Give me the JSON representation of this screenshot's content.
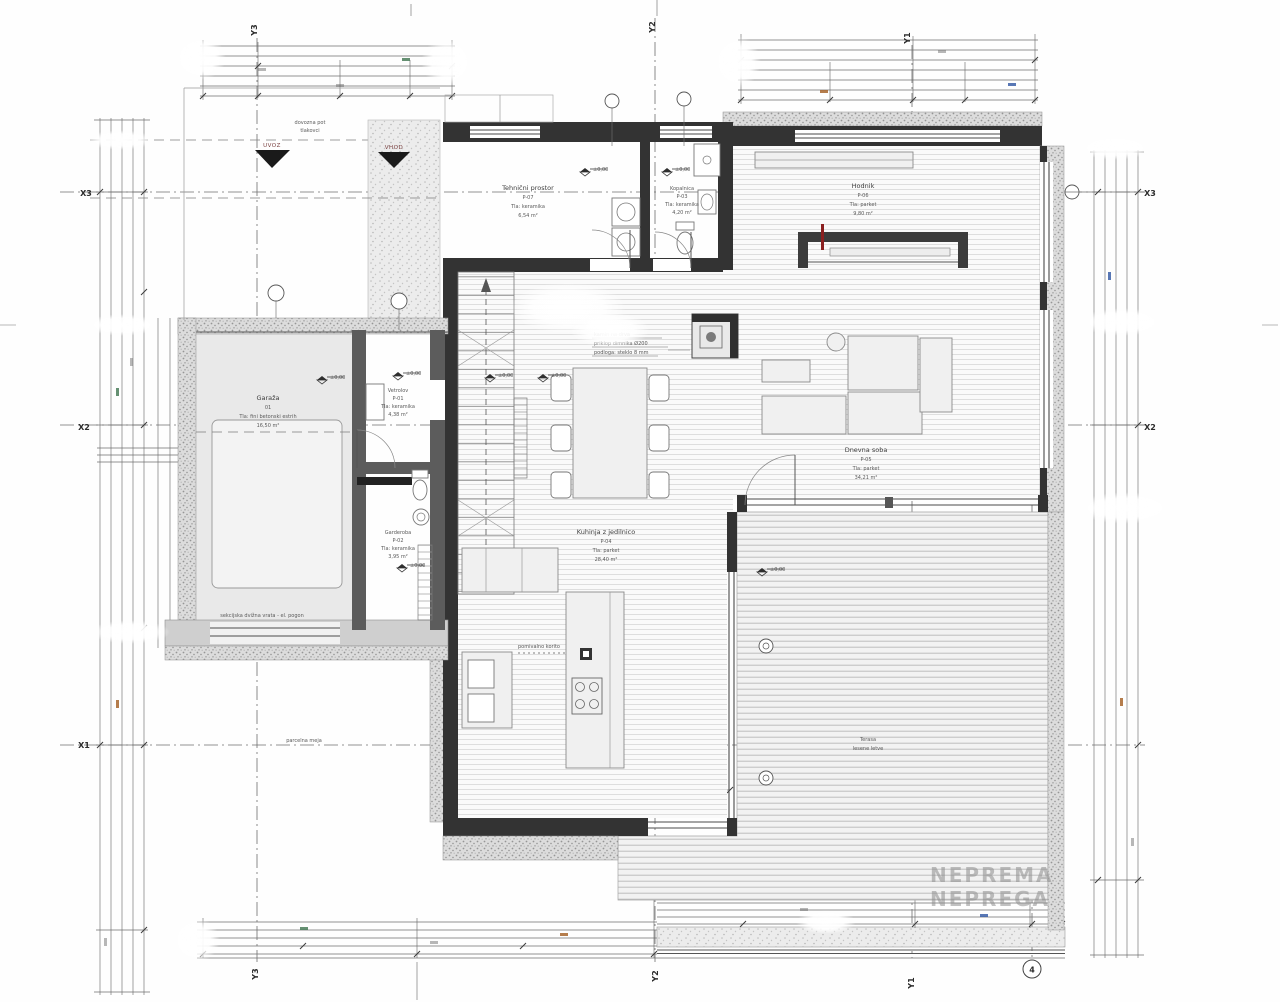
{
  "drawing": {
    "type": "architectural floor plan, ground floor",
    "accent_wall_color": "#333333",
    "stipple_wall_color": "#dcdcdc",
    "paper_color": "#fefefe"
  },
  "grid": {
    "top": [
      "Y3",
      "Y2",
      "Y1"
    ],
    "bottom": [
      "Y3",
      "Y2",
      "Y1"
    ],
    "left": [
      "X3",
      "X2",
      "X1"
    ],
    "right": [
      "X3",
      "X2"
    ],
    "axis_bubble": "4"
  },
  "rooms": {
    "garage": {
      "lines": [
        "Garaža",
        "01",
        "Tla: fini betonski estrih",
        "16,50 m²"
      ]
    },
    "vetrolov": {
      "lines": [
        "Vetrolov",
        "P-01",
        "Tla: keramika",
        "4,38 m²"
      ]
    },
    "garderoba": {
      "lines": [
        "Garderoba",
        "P-02",
        "Tla: keramika",
        "3,95 m²"
      ]
    },
    "utility": {
      "lines": [
        "Tehnični prostor",
        "P-07",
        "Tla: keramika",
        "6,54 m²"
      ]
    },
    "bath": {
      "lines": [
        "Kopalnica",
        "P-03",
        "Tla: keramika",
        "4,20 m²"
      ]
    },
    "hall": {
      "lines": [
        "Hodnik",
        "P-06",
        "Tla: parket",
        "9,80 m²"
      ]
    },
    "living": {
      "lines": [
        "Dnevna soba",
        "P-05",
        "Tla: parket",
        "34,21 m²"
      ]
    },
    "kitchen": {
      "lines": [
        "Kuhinja z jedilnico",
        "P-04",
        "Tla: parket",
        "28,40 m²"
      ]
    },
    "terrace": {
      "lines": [
        "Terasa",
        "lesene letve"
      ]
    }
  },
  "annotations": {
    "driveway": [
      "dovozna pot",
      "tlakovci"
    ],
    "uvoz": "UVOZ",
    "vhod": "VHOD",
    "garage_door": "sekcijska dvižna vrata - el. pogon",
    "fireplace": [
      "kamin na drva",
      "priklop dimnika Ø200",
      "podloga: steklo 8 mm"
    ],
    "island_note": "pomivalno korito",
    "boundary": "parcelna meja",
    "level": "±0,00"
  },
  "watermark": [
    "NEPREMA",
    "NEPREGA"
  ]
}
